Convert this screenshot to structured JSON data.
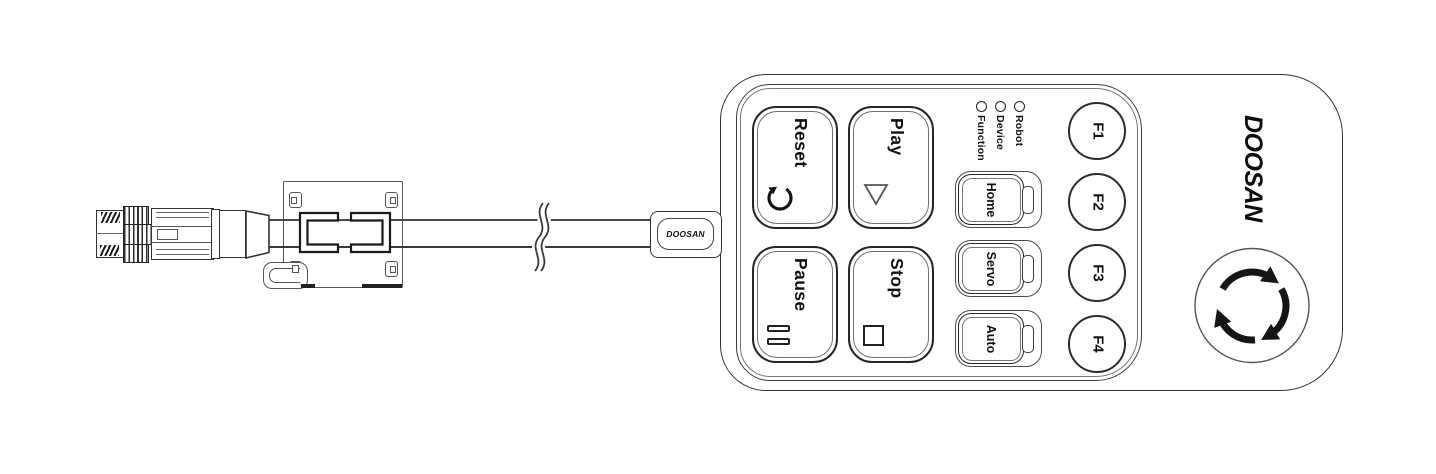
{
  "colors": {
    "background": "#ffffff",
    "line": "#333333",
    "line_soft": "#555555",
    "ink": "#121212"
  },
  "icons": [
    "connector-thread-icon",
    "coupling-nut-knurl-icon",
    "cable-break-icon",
    "ferrite-clamp-bracket-icon",
    "reset-arrow-icon",
    "play-triangle-icon",
    "pause-bars-icon",
    "stop-square-icon",
    "status-led-icon",
    "mode-led-slot-icon",
    "twist-release-arrows-icon"
  ],
  "cable": {
    "brand_label": "DOOSAN"
  },
  "pendant": {
    "brand_logo": "DOOSAN",
    "keypad_buttons": [
      {
        "label": "Reset",
        "icon": "reset-arrow-icon"
      },
      {
        "label": "Play",
        "icon": "play-triangle-icon"
      },
      {
        "label": "Pause",
        "icon": "pause-bars-icon"
      },
      {
        "label": "Stop",
        "icon": "stop-square-icon"
      }
    ],
    "mode_buttons": [
      {
        "label": "Home"
      },
      {
        "label": "Servo"
      },
      {
        "label": "Auto"
      }
    ],
    "function_buttons": [
      {
        "label": "F1"
      },
      {
        "label": "F2"
      },
      {
        "label": "F3"
      },
      {
        "label": "F4"
      }
    ],
    "status_leds": [
      {
        "label": "Function"
      },
      {
        "label": "Device"
      },
      {
        "label": "Robot"
      }
    ]
  }
}
